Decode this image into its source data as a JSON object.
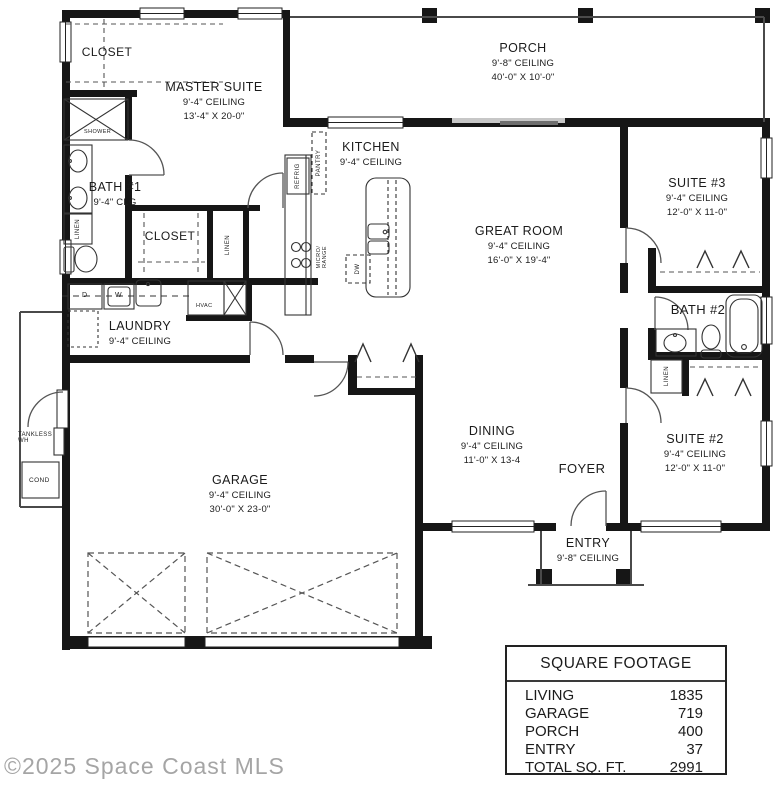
{
  "watermark": "©2025 Space Coast MLS",
  "rooms": {
    "closet_master": {
      "name": "CLOSET"
    },
    "master_suite": {
      "name": "MASTER SUITE",
      "ceiling": "9'-4\" CEILING",
      "dims": "13'-4\" X 20-0\""
    },
    "bath1": {
      "name": "BATH #1",
      "ceiling": "9'-4\" CLG"
    },
    "porch": {
      "name": "PORCH",
      "ceiling": "9'-8\" CEILING",
      "dims": "40'-0\" X 10'-0\""
    },
    "kitchen": {
      "name": "KITCHEN",
      "ceiling": "9'-4\" CEILING"
    },
    "great_room": {
      "name": "GREAT ROOM",
      "ceiling": "9'-4\" CEILING",
      "dims": "16'-0\" X 19'-4\""
    },
    "suite3": {
      "name": "SUITE #3",
      "ceiling": "9'-4\" CEILING",
      "dims": "12'-0\" X 11-0\""
    },
    "bath2": {
      "name": "BATH #2"
    },
    "suite2": {
      "name": "SUITE #2",
      "ceiling": "9'-4\" CEILING",
      "dims": "12'-0\" X 11-0\""
    },
    "closet_hall": {
      "name": "CLOSET"
    },
    "laundry": {
      "name": "LAUNDRY",
      "ceiling": "9'-4\" CEILING"
    },
    "garage": {
      "name": "GARAGE",
      "ceiling": "9'-4\" CEILING",
      "dims": "30'-0\" X 23-0\""
    },
    "dining": {
      "name": "DINING",
      "ceiling": "9'-4\" CEILING",
      "dims": "11'-0\" X 13-4"
    },
    "foyer": {
      "name": "FOYER"
    },
    "entry": {
      "name": "ENTRY",
      "ceiling": "9'-8\" CEILING"
    }
  },
  "fixtures": {
    "shower": "SHOWER",
    "linen": "LINEN",
    "pantry": "PANTRY",
    "refrig": "REFRIG",
    "micro": "MICRO/",
    "range": "RANGE",
    "dw": "DW",
    "hvac": "HVAC",
    "dryer": "D",
    "washer": "W",
    "tankless_line1": "TANKLESS",
    "tankless_line2": "WH",
    "cond": "COND"
  },
  "square_footage": {
    "title": "SQUARE FOOTAGE",
    "rows": [
      {
        "label": "LIVING",
        "value": "1835"
      },
      {
        "label": "GARAGE",
        "value": "719"
      },
      {
        "label": "PORCH",
        "value": "400"
      },
      {
        "label": "ENTRY",
        "value": "37"
      },
      {
        "label": "TOTAL SQ. FT.",
        "value": "2991"
      }
    ]
  }
}
